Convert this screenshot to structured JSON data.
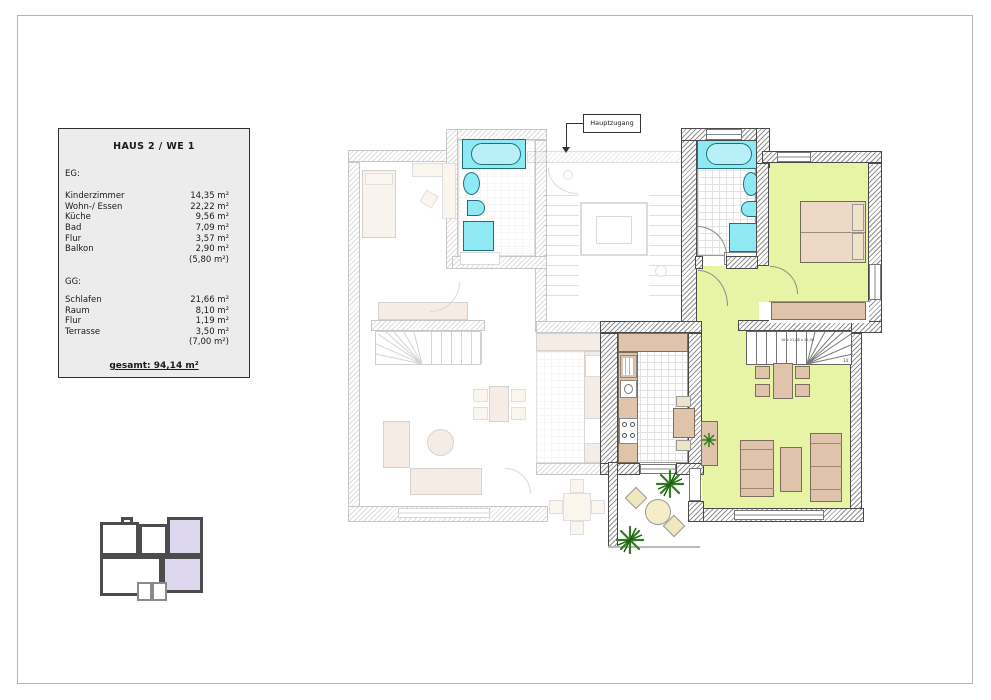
{
  "legend": {
    "title": "HAUS 2 / WE 1",
    "sections": [
      {
        "label": "EG:",
        "rows": [
          {
            "name": "Kinderzimmer",
            "value": "14,35 m²"
          },
          {
            "name": "Wohn-/ Essen",
            "value": "22,22 m²"
          },
          {
            "name": "Küche",
            "value": "9,56 m²"
          },
          {
            "name": "Bad",
            "value": "7,09 m²"
          },
          {
            "name": "Flur",
            "value": "3,57 m²"
          },
          {
            "name": "Balkon",
            "value": "2,90 m²"
          },
          {
            "name": "",
            "value": "(5,80 m²)"
          }
        ]
      },
      {
        "label": "GG:",
        "rows": [
          {
            "name": "Schlafen",
            "value": "21,66 m²"
          },
          {
            "name": "Raum",
            "value": "8,10 m²"
          },
          {
            "name": "Flur",
            "value": "1,19 m²"
          },
          {
            "name": "Terrasse",
            "value": "3,50 m²"
          },
          {
            "name": "",
            "value": "(7,00 m²)"
          }
        ]
      }
    ],
    "total": "gesamt: 94,14 m²"
  },
  "plan": {
    "entrance_label": "Hauptzugang",
    "stair_dimension_note": "16 x 21,88 x 25,00",
    "stair_step_label": "14",
    "highlight_room_color": "#e7f3a5",
    "fixture_color": "#8fe9f2",
    "furniture_color": "#dfc3ab"
  },
  "keyplan": {
    "highlight_color": "#dcd6ee",
    "outline_color": "#4c4c4c"
  }
}
